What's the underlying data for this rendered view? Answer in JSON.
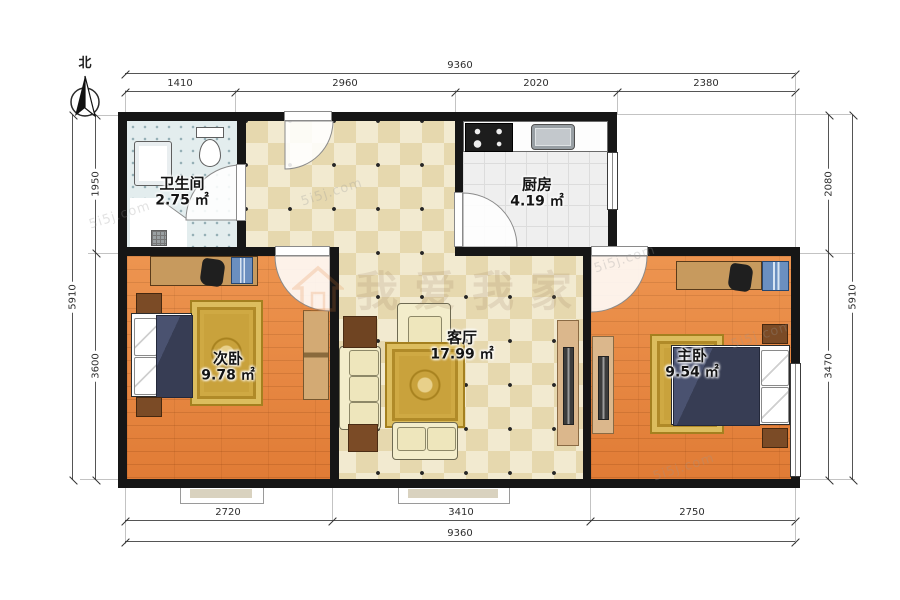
{
  "north_label": "北",
  "rooms": {
    "bathroom": {
      "name": "卫生间",
      "area": "2.75 ㎡"
    },
    "kitchen": {
      "name": "厨房",
      "area": "4.19 ㎡"
    },
    "living": {
      "name": "客厅",
      "area": "17.99 ㎡"
    },
    "bedroom2": {
      "name": "次卧",
      "area": "9.78 ㎡"
    },
    "bedroom1": {
      "name": "主卧",
      "area": "9.54 ㎡"
    }
  },
  "dimensions": {
    "top": {
      "total": "9360",
      "seg1": "1410",
      "seg2": "2960",
      "seg3": "2020",
      "seg4": "2380"
    },
    "bottom": {
      "total": "9360",
      "seg1": "2720",
      "seg2": "3410",
      "seg3": "2750"
    },
    "left": {
      "total": "5910",
      "seg1": "1950",
      "seg2": "3600"
    },
    "right": {
      "total": "5910",
      "seg1": "2080",
      "seg2": "3470"
    }
  },
  "watermark": {
    "brand": "5i5j.com",
    "center_text": "我爱我家"
  },
  "colors": {
    "wall": "#161616",
    "wood_floor": "#e8833c",
    "living_tile": "#e6d8ae",
    "bath_tile": "#e3edee",
    "kitchen_tile": "#efefef",
    "rug": "#c9a23c",
    "bed_blanket": "#3c4258",
    "furniture_brown": "#7b4b26"
  }
}
